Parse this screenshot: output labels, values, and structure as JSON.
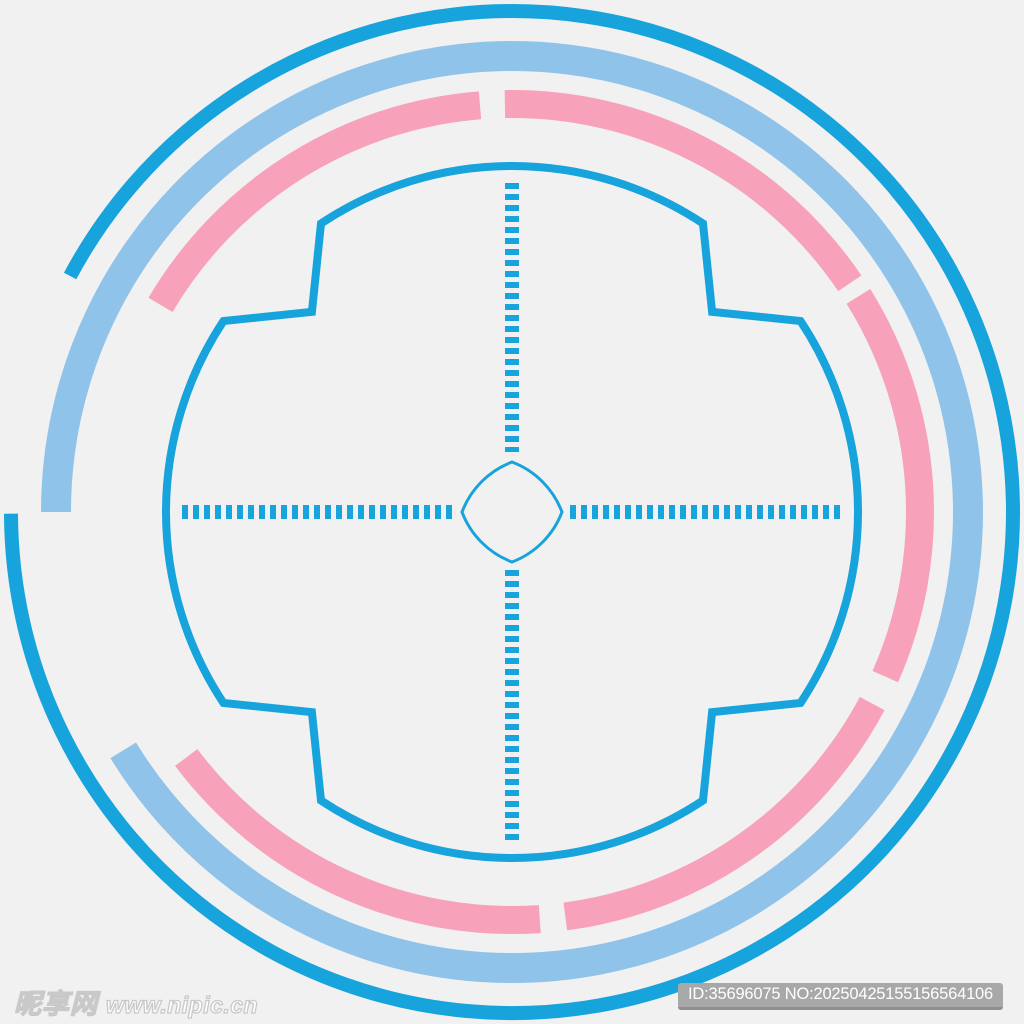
{
  "canvas": {
    "width": 1024,
    "height": 1024,
    "background": "#f1f1f2"
  },
  "colors": {
    "blue": "#17a3db",
    "light_blue": "#90c3e9",
    "pink": "#f7a2ba"
  },
  "center": {
    "x": 512,
    "y": 512
  },
  "rings": [
    {
      "name": "outer-blue-ring",
      "color": "blue",
      "radius": 501,
      "stroke": 14,
      "segments": [
        [
          208.1,
          539.8
        ]
      ]
    },
    {
      "name": "light-blue-ring",
      "color": "light_blue",
      "radius": 456,
      "stroke": 30,
      "segments": [
        [
          180.0,
          508.5
        ]
      ]
    },
    {
      "name": "pink-ring",
      "color": "pink",
      "radius": 408,
      "stroke": 28,
      "segments": [
        [
          210.5,
          265.5
        ],
        [
          269.0,
          325.9
        ],
        [
          328.1,
          383.8
        ],
        [
          388.0,
          442.5
        ],
        [
          446.1,
          503.0
        ]
      ]
    }
  ],
  "reticle": {
    "name": "reticle-outline",
    "color": "blue",
    "stroke": 8,
    "radius": 346,
    "corner_radius": 283,
    "arc_half_span": 33.5,
    "start_angle": 236.5,
    "cardinals": [
      270,
      360,
      450,
      540
    ]
  },
  "crosshair": {
    "name": "crosshair-dashed-line",
    "color": "blue",
    "stroke": 14,
    "dash": 6,
    "gap": 5,
    "segments": [
      {
        "x1": 512,
        "y1": 183,
        "x2": 512,
        "y2": 452
      },
      {
        "x1": 512,
        "y1": 570,
        "x2": 512,
        "y2": 841
      },
      {
        "x1": 182,
        "y1": 512,
        "x2": 452,
        "y2": 512
      },
      {
        "x1": 570,
        "y1": 512,
        "x2": 841,
        "y2": 512
      }
    ]
  },
  "center_star": {
    "name": "center-star-outline",
    "color": "blue",
    "stroke": 3,
    "tip_radius": 50,
    "side_arc_radius": 86,
    "tip_angles": [
      270,
      0,
      90,
      180
    ]
  },
  "watermark": {
    "site_logo": "昵享网",
    "site_url": "www.nipic.cn",
    "badge_text": "ID:35696075 NO:20250425155156564106"
  }
}
